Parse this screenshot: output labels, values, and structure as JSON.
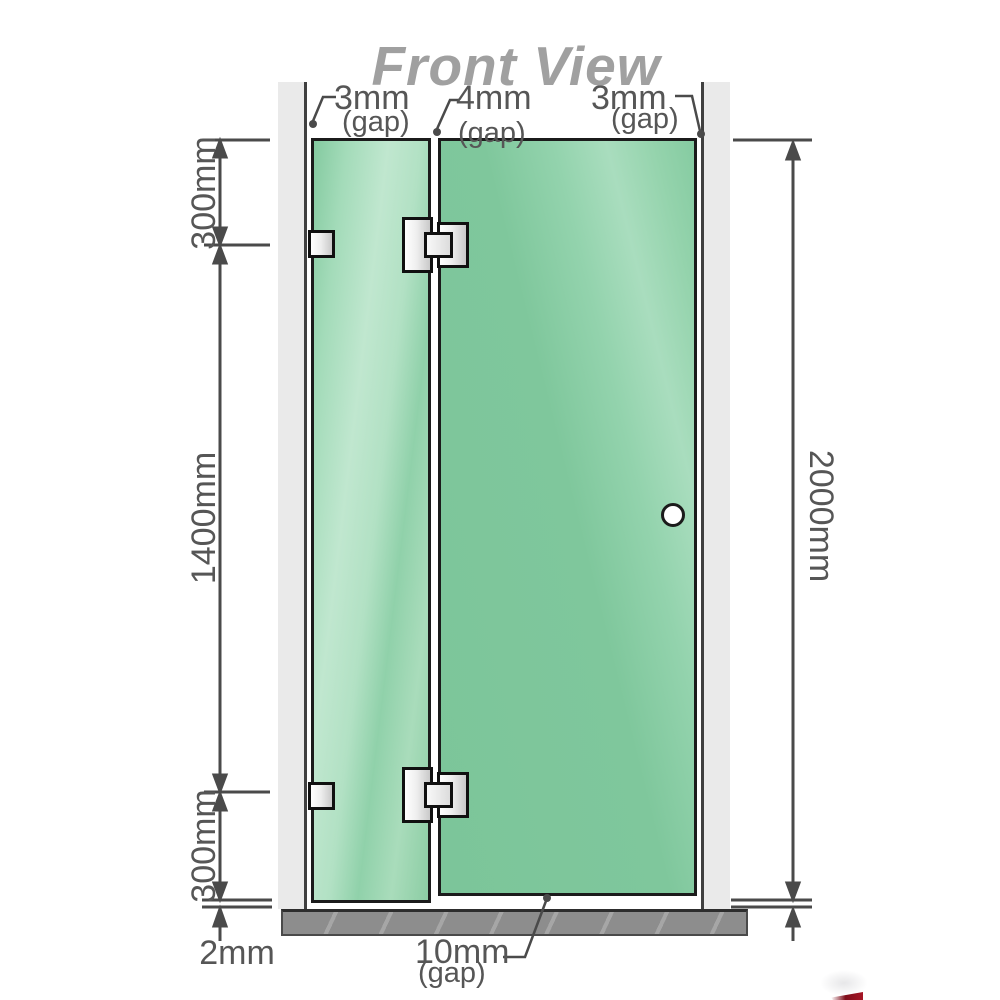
{
  "title": "Front View",
  "top_gap_labels": [
    {
      "value": "3mm",
      "unit": "(gap)"
    },
    {
      "value": "4mm",
      "unit": "(gap)"
    },
    {
      "value": "3mm",
      "unit": "(gap)"
    }
  ],
  "left_dimensions": {
    "top": "300mm",
    "middle": "1400mm",
    "bottom": "300mm",
    "floor_gap": "2mm"
  },
  "right_dimension": "2000mm",
  "bottom_gap": {
    "value": "10mm",
    "unit": "(gap)"
  },
  "colors": {
    "glass": "#7fc79c",
    "glass_highlight": "#b7e2c8",
    "glass_edge": "#1b1b1b",
    "wall": "#eaeaea",
    "wall_edge": "#404040",
    "floor": "#8d8d8d",
    "dim_line": "#4a4a4a",
    "label_gray": "#565656",
    "title_gray": "#a0a0a0",
    "hardware_edge": "#101010",
    "logo_red": "#a61626"
  }
}
